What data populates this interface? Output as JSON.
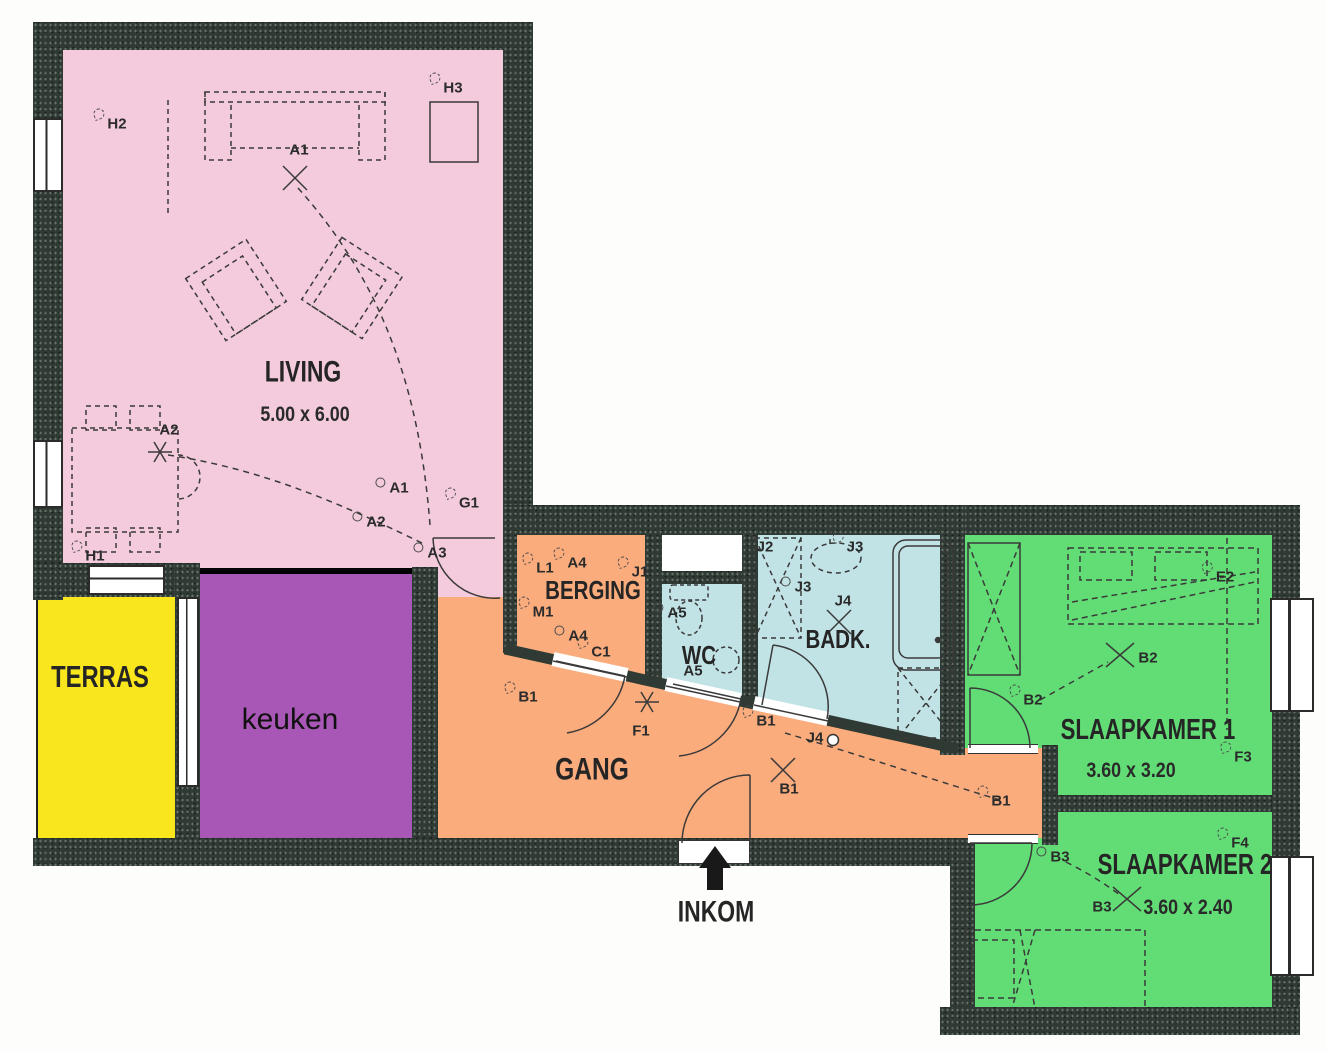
{
  "plan": {
    "type": "apartment floor plan with electrical points",
    "language": "Dutch"
  },
  "rooms": {
    "living": {
      "name": "LIVING",
      "dims": "5.00 x 6.00",
      "color": "#f3cbdc"
    },
    "terras": {
      "name": "TERRAS",
      "color": "#fae61c"
    },
    "keuken": {
      "name": "keuken",
      "color": "#a957b7"
    },
    "gang": {
      "name": "GANG",
      "color": "#fbac7d"
    },
    "berging": {
      "name": "BERGING",
      "color": "#fbac7d"
    },
    "wc": {
      "name": "WC",
      "color": "#c2e3e6"
    },
    "badkamer": {
      "name": "BADK.",
      "color": "#c2e3e6"
    },
    "slaapkamer1": {
      "name": "SLAAPKAMER 1",
      "dims": "3.60 x 3.20",
      "color": "#62dd76"
    },
    "slaapkamer2": {
      "name": "SLAAPKAMER 2",
      "dims": "3.60 x 2.40",
      "color": "#62dd76"
    }
  },
  "entrance": {
    "label": "INKOM"
  },
  "colors": {
    "wall": "#2e3a33",
    "living_pink": "#f3cbdc",
    "terras_yellow": "#fae61c",
    "keuken_purple": "#a957b7",
    "gang_orange": "#fbac7d",
    "sanitary_cyan": "#c2e3e6",
    "bedroom_green": "#62dd76",
    "line_dark": "#3a3a3a"
  },
  "symbols": [
    {
      "code": "H2",
      "x": 117,
      "y": 124,
      "glyph": "branch"
    },
    {
      "code": "H3",
      "x": 453,
      "y": 88,
      "glyph": "branch"
    },
    {
      "code": "A1",
      "x": 299,
      "y": 150,
      "glyph": "none"
    },
    {
      "code": "A2",
      "x": 169,
      "y": 430,
      "glyph": "none"
    },
    {
      "code": "H1",
      "x": 95,
      "y": 556,
      "glyph": "branch"
    },
    {
      "code": "A1",
      "x": 399,
      "y": 488,
      "glyph": "circle"
    },
    {
      "code": "G1",
      "x": 469,
      "y": 503,
      "glyph": "branch"
    },
    {
      "code": "A2",
      "x": 376,
      "y": 522,
      "glyph": "circle"
    },
    {
      "code": "A3",
      "x": 437,
      "y": 553,
      "glyph": "circle"
    },
    {
      "code": "L1",
      "x": 545,
      "y": 568,
      "glyph": "branch"
    },
    {
      "code": "A4",
      "x": 577,
      "y": 563,
      "glyph": "branch"
    },
    {
      "code": "J1",
      "x": 640,
      "y": 572,
      "glyph": "branch"
    },
    {
      "code": "M1",
      "x": 543,
      "y": 612,
      "glyph": "branch"
    },
    {
      "code": "A4",
      "x": 578,
      "y": 636,
      "glyph": "circle"
    },
    {
      "code": "C1",
      "x": 601,
      "y": 652,
      "glyph": "branch"
    },
    {
      "code": "B1",
      "x": 528,
      "y": 697,
      "glyph": "branch"
    },
    {
      "code": "F1",
      "x": 641,
      "y": 731,
      "glyph": "none"
    },
    {
      "code": "B1",
      "x": 766,
      "y": 721,
      "glyph": "branch"
    },
    {
      "code": "J4",
      "x": 815,
      "y": 738,
      "glyph": "none"
    },
    {
      "code": "B1",
      "x": 789,
      "y": 789,
      "glyph": "none"
    },
    {
      "code": "B1",
      "x": 1001,
      "y": 801,
      "glyph": "branch"
    },
    {
      "code": "A5",
      "x": 677,
      "y": 613,
      "glyph": "circle"
    },
    {
      "code": "A5",
      "x": 693,
      "y": 671,
      "glyph": "none"
    },
    {
      "code": "J2",
      "x": 765,
      "y": 547,
      "glyph": "branch"
    },
    {
      "code": "J3",
      "x": 855,
      "y": 547,
      "glyph": "branch"
    },
    {
      "code": "J3",
      "x": 803,
      "y": 587,
      "glyph": "circle"
    },
    {
      "code": "J4",
      "x": 843,
      "y": 601,
      "glyph": "none"
    },
    {
      "code": "E2",
      "x": 1225,
      "y": 577,
      "glyph": "branch"
    },
    {
      "code": "B2",
      "x": 1148,
      "y": 658,
      "glyph": "none"
    },
    {
      "code": "B2",
      "x": 1033,
      "y": 700,
      "glyph": "branch"
    },
    {
      "code": "F3",
      "x": 1243,
      "y": 757,
      "glyph": "branch"
    },
    {
      "code": "F4",
      "x": 1240,
      "y": 843,
      "glyph": "branch"
    },
    {
      "code": "B3",
      "x": 1060,
      "y": 857,
      "glyph": "circle"
    },
    {
      "code": "B3",
      "x": 1102,
      "y": 907,
      "glyph": "none"
    }
  ]
}
